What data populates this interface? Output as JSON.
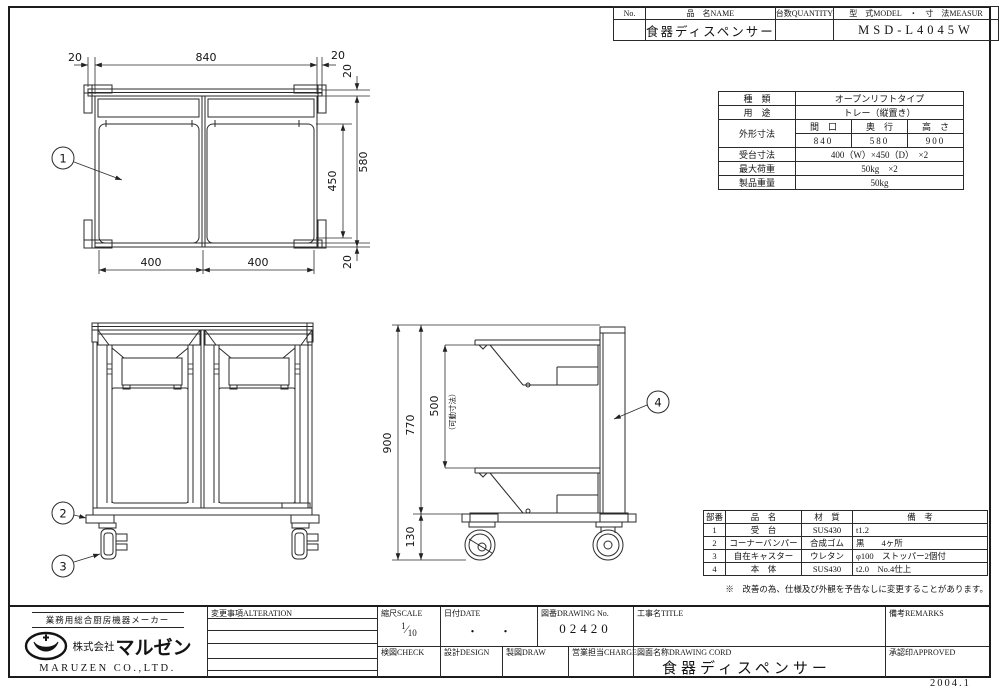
{
  "page": {
    "footer_date": "2004.1"
  },
  "header_table": {
    "no_label": "No.",
    "name_label": "品　名NAME",
    "qty_label": "台数QUANTITY",
    "model_label": "型　式MODEL　・　寸　法MEASUR",
    "name_value": "食器ディスペンサー",
    "qty_value": "",
    "model_value": "MSD-L4045W"
  },
  "spec_table": {
    "kind_label": "種　類",
    "kind_value": "オープンリフトタイプ",
    "use_label": "用　途",
    "use_value": "トレー（縦置き）",
    "outer_dim_label": "外形寸法",
    "width_label": "間　口",
    "depth_label": "奥　行",
    "height_label": "高　さ",
    "width_value": "840",
    "depth_value": "580",
    "height_value": "900",
    "base_dim_label": "受台寸法",
    "base_dim_value": "400（W）×450（D）　×2",
    "max_load_label": "最大荷重",
    "max_load_value": "50kg　×2",
    "weight_label": "製品重量",
    "weight_value": "50kg"
  },
  "parts_table": {
    "headers": {
      "no": "部番",
      "name": "品　名",
      "material": "材　質",
      "remarks": "備　考"
    },
    "rows": [
      {
        "no": "1",
        "name": "受　台",
        "material": "SUS430",
        "remarks": "t1.2"
      },
      {
        "no": "2",
        "name": "コーナーバンパー",
        "material": "合成ゴム",
        "remarks": "黒　　4ヶ所"
      },
      {
        "no": "3",
        "name": "自在キャスター",
        "material": "ウレタン",
        "remarks": "φ100　ストッパー2個付"
      },
      {
        "no": "4",
        "name": "本　体",
        "material": "SUS430",
        "remarks": "t2.0　No.4仕上"
      }
    ],
    "note": "※　改善の為、仕様及び外観を予告なしに変更することがあります。"
  },
  "title_block": {
    "alteration_label": "変更事項ALTERATION",
    "scale_label": "縮尺SCALE",
    "scale_num": "1",
    "scale_den": "10",
    "date_label": "日付DATE",
    "date_value": "・　　・",
    "drawing_no_label": "図番DRAWING No.",
    "drawing_no_value": "02420",
    "title_label": "工事名TITLE",
    "remarks_label": "備考REMARKS",
    "check_label": "検図CHECK",
    "design_label": "設計DESIGN",
    "draw_label": "製図DRAW",
    "charge_label": "営業担当CHARGE",
    "drawing_name_label": "図面名称DRAWING CORD",
    "drawing_name_value": "食器ディスペンサー",
    "approved_label": "承認印APPROVED"
  },
  "company": {
    "tagline": "業務用総合厨房機器メーカー",
    "name_prefix": "株式会社",
    "name_logo": "マルゼン",
    "name_en": "MARUZEN CO.,LTD."
  },
  "drawing": {
    "plan_view": {
      "dim_top_left": "20",
      "dim_top_center": "840",
      "dim_top_right": "20",
      "dim_right_top": "20",
      "dim_right_depth": "580",
      "dim_right_opening": "450",
      "dim_right_bottom": "20",
      "dim_bottom_left": "400",
      "dim_bottom_right": "400",
      "balloon": "1"
    },
    "front_view": {
      "balloon_bumper": "2",
      "balloon_caster": "3"
    },
    "side_view": {
      "dim_total_height": "900",
      "dim_body_height": "770",
      "dim_stroke": "500",
      "dim_stroke_note": "（可動寸法）",
      "dim_caster_height": "130",
      "balloon": "4"
    }
  }
}
